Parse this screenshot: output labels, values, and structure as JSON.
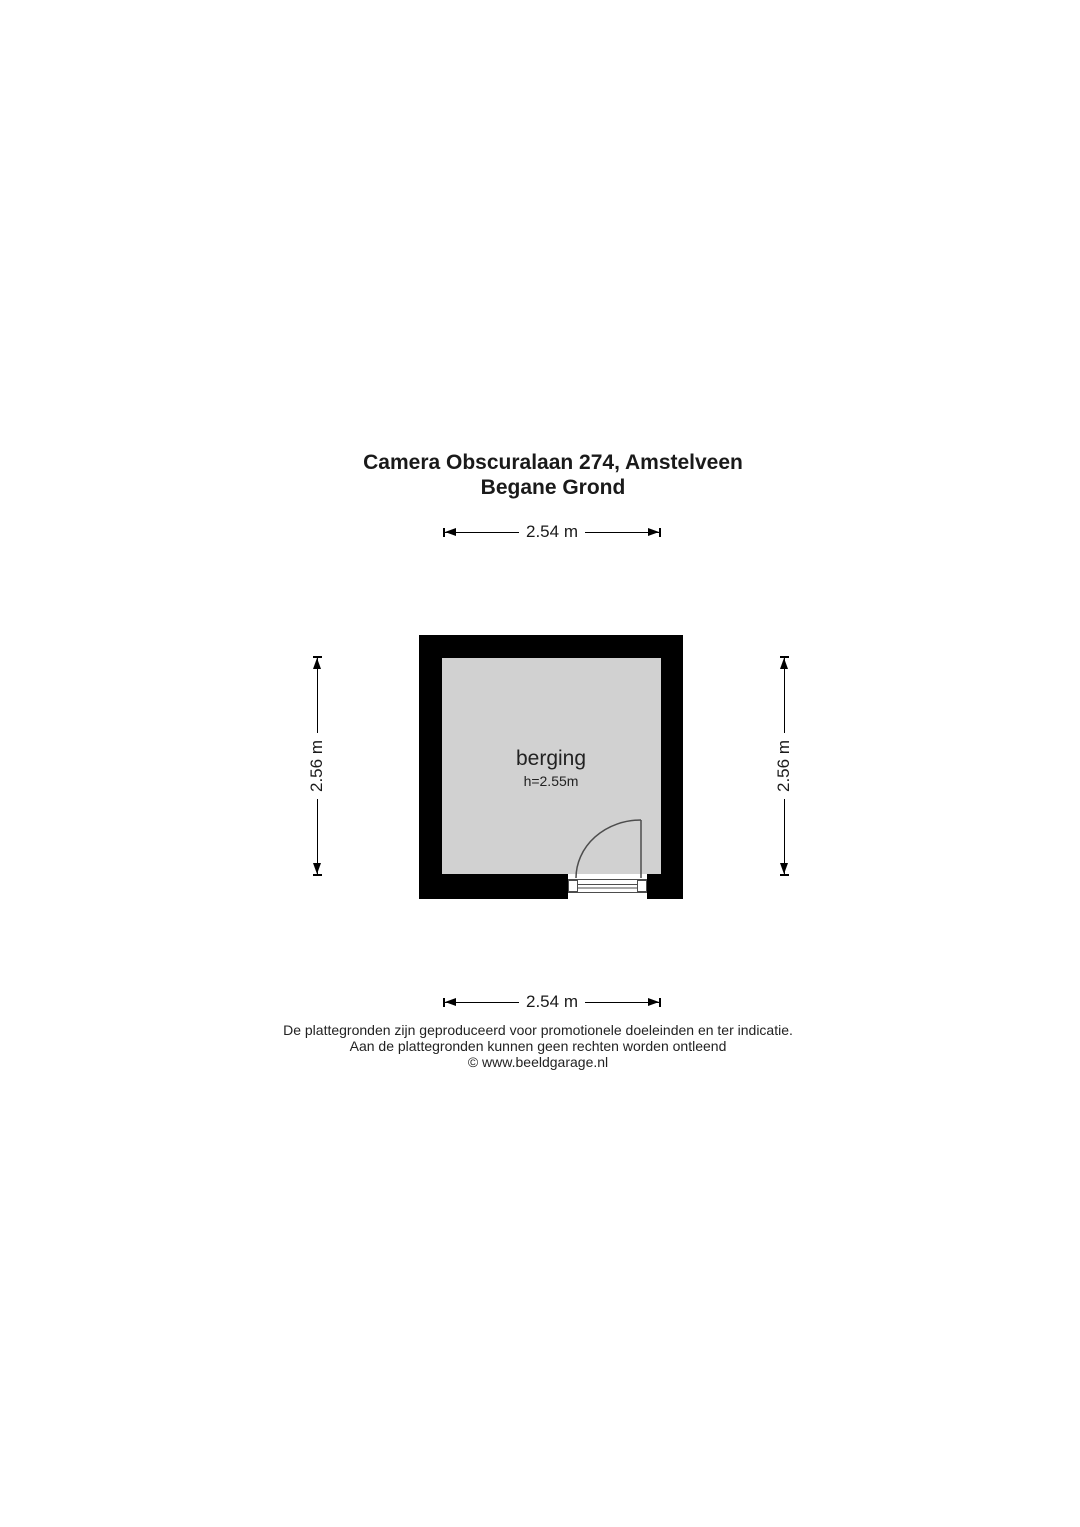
{
  "title": {
    "line1": "Camera Obscuralaan 274, Amstelveen",
    "line2": "Begane Grond"
  },
  "floorplan": {
    "room": {
      "label": "berging",
      "ceiling_height": "h=2.55m"
    },
    "dimensions": {
      "top": "2.54 m",
      "bottom": "2.54 m",
      "left": "2.56 m",
      "right": "2.56 m"
    },
    "colors": {
      "wall": "#000000",
      "floor": "#d1d1d1",
      "door_line": "#4d4d4d",
      "dimension_line": "#000000"
    }
  },
  "footer": {
    "line1": "De plattegronden zijn geproduceerd voor promotionele doeleinden en ter indicatie.",
    "line2": "Aan de plattegronden kunnen geen rechten worden ontleend",
    "line3": "© www.beeldgarage.nl"
  }
}
